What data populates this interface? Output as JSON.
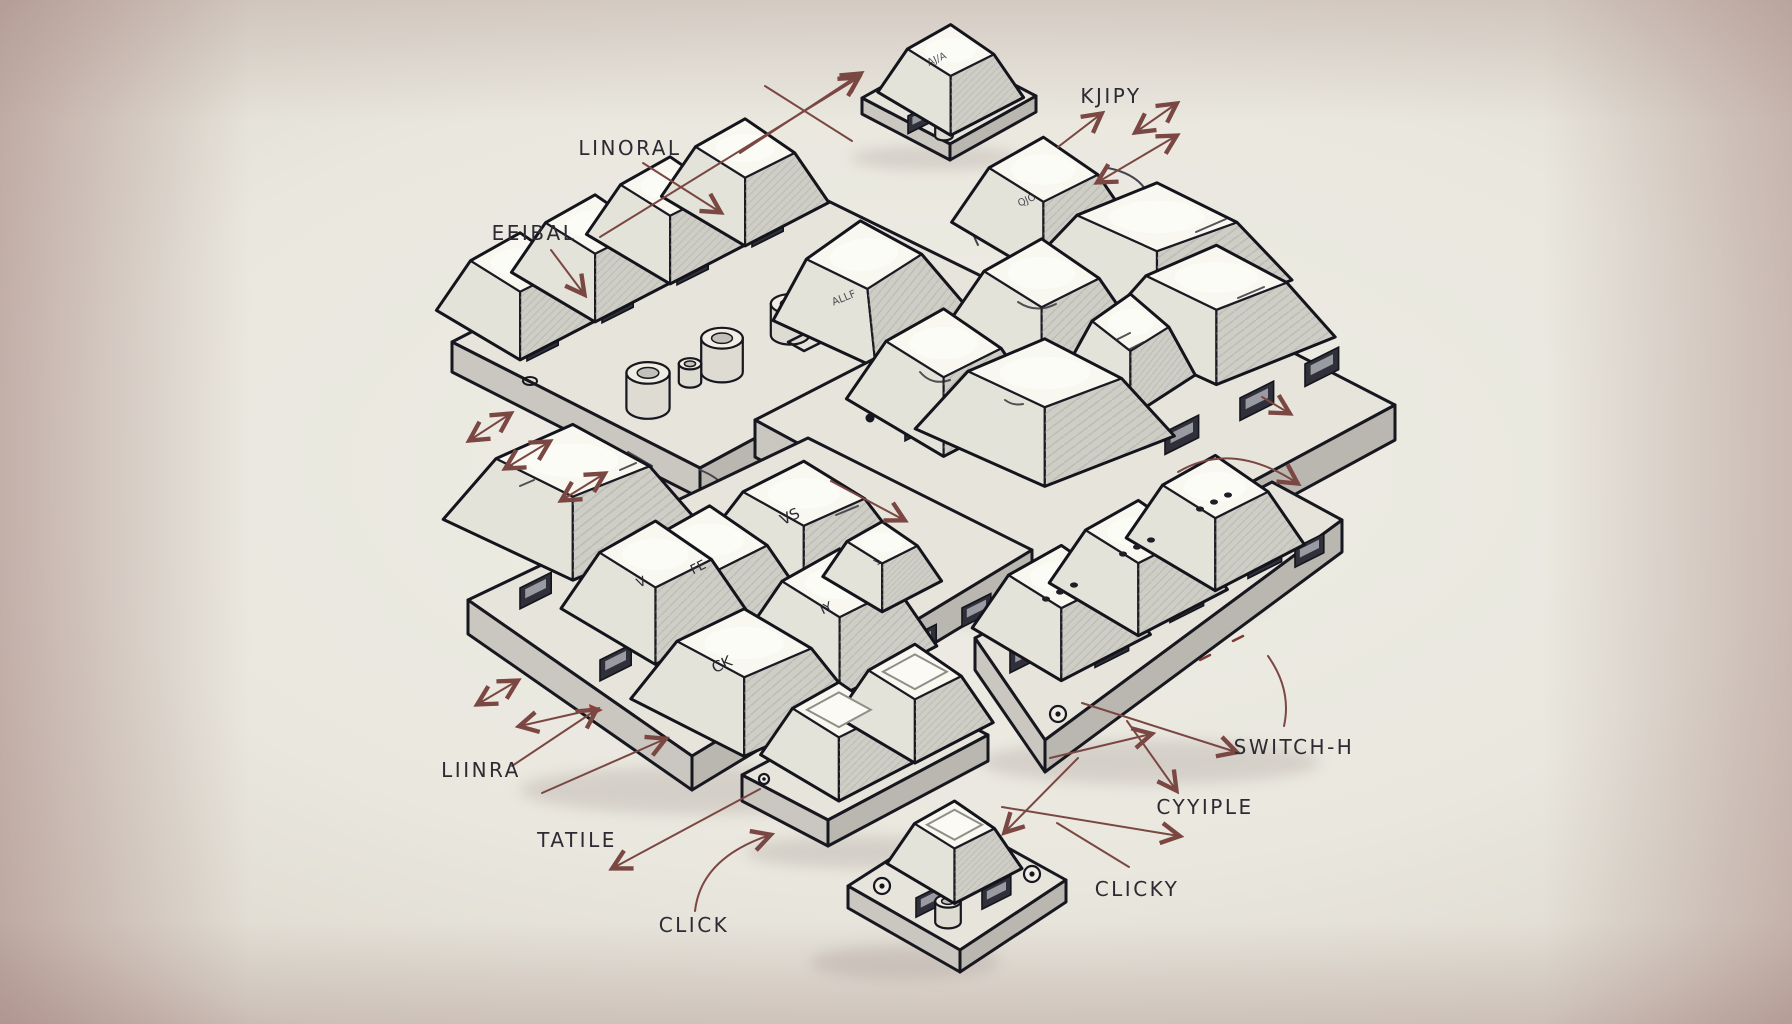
{
  "scene": {
    "description": "Hand-drawn isometric illustration of mechanical keyboard switch clusters on PCB plates, annotated with gibberish labels and thin dark-red arrows"
  },
  "labels": {
    "linoral": "LINORAL",
    "eeibal": "EEIBAL",
    "kjipy": "KJIPY",
    "liinra": "LIINRA",
    "tatile": "TATILE",
    "click": "CLICK",
    "cyyiple": "CYYIPLE",
    "clicky": "CLICKY",
    "switch_h": "SWITCH-H"
  },
  "key_legends": {
    "top_single": "AJ/A",
    "detached_side": "ALLF",
    "qjo": "QJO",
    "vs": "VS",
    "fe": "FE",
    "v": "V",
    "ck": "CK",
    "iy": "IY",
    "arrow_key": "↘"
  },
  "colors": {
    "background_center": "#edece4",
    "background_edge": "#a98d8b",
    "ink": "#17171f",
    "arrow": "#7a4742",
    "keycap": "#f8f7f0",
    "plate": "#e6e4db",
    "accent_red": "#a03a31"
  }
}
